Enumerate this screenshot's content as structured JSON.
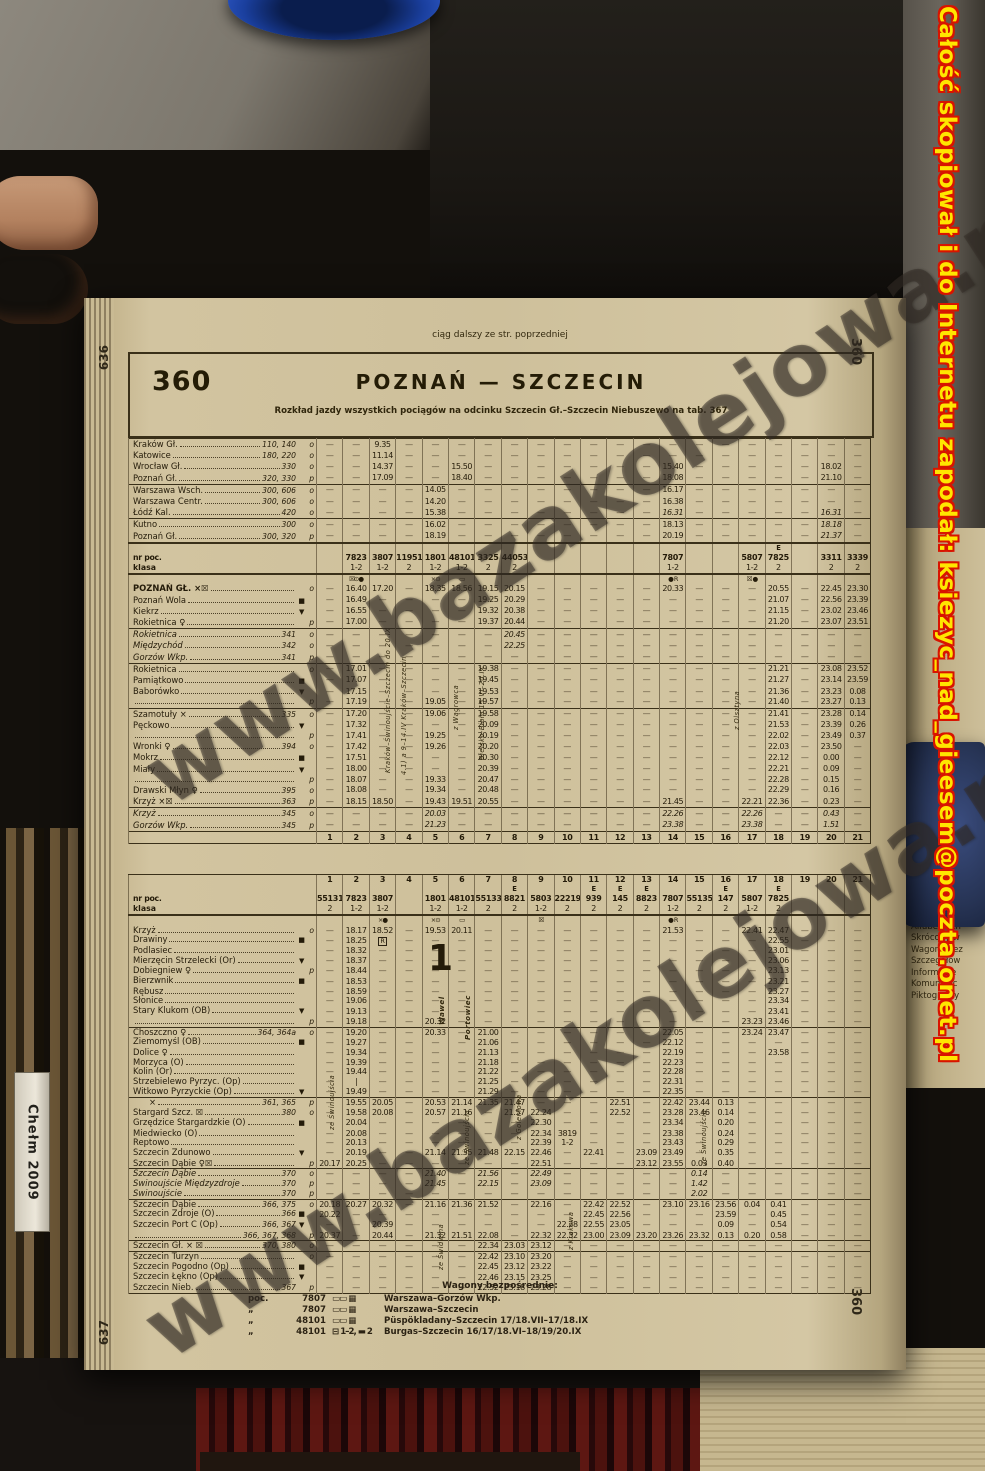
{
  "photo": {
    "red_overlay_text": "Całość skopiował i do Internetu zapodał: ksiezyc_nad_gieesem@poczta.onet.pl",
    "watermark": "www.bazakolejowa.pl",
    "left_spine_text": "Chełm 2009",
    "neighbor_page_lines": [
      "Infor. koleje",
      "Alfabetyczn",
      "Skrócony w",
      "Wagony bez",
      "Szczegółow",
      "Informacje",
      "Komunikac",
      "Piktogramy"
    ]
  },
  "upper_page": {
    "continuation_note": "ciąg dalszy ze str. poprzedniej",
    "page_edge_number": "636",
    "margin_number": "360",
    "table_number": "360",
    "title": "POZNAŃ — SZCZECIN",
    "subtitle": "Rozkład jazdy wszystkich pociągów na odcinku Szczecin Gł.–Szczecin Niebuszewo na tab. 367",
    "header": {
      "nr_label": "nr poc.",
      "klasa_label": "klasa",
      "nr": {
        "2": "7823",
        "3": "3807",
        "4": "11951",
        "5": "1801",
        "6": "48101",
        "7": "3325",
        "8": "44053",
        "14": "7807",
        "17": "5807",
        "18": "7825",
        "20": "3311",
        "21": "3339"
      },
      "klasa": {
        "2": "1-2",
        "3": "1-2",
        "4": "2",
        "5": "1-2",
        "6": "1-2",
        "7": "2",
        "8": "2",
        "14": "1-2",
        "17": "1-2",
        "18": "2",
        "20": "2",
        "21": "2"
      },
      "e_cols": {
        "18": "E"
      },
      "syms": {
        "2": "☒⊙●",
        "5": "×⊙",
        "6": "▭",
        "14": "● R",
        "17": "☒ ●"
      }
    },
    "origin_rows": [
      {
        "n": "Kraków Gł.",
        "r": "110, 140",
        "a": "o",
        "c": {
          "3": "9.35"
        }
      },
      {
        "n": "Katowice",
        "r": "180, 220",
        "a": "o",
        "c": {
          "3": "11.14"
        }
      },
      {
        "n": "Wrocław Gł.",
        "r": "330",
        "a": "o",
        "c": {
          "3": "14.37",
          "6": "15.50",
          "14": "15.40",
          "20": "18.02"
        }
      },
      {
        "n": "Poznań Gł.",
        "r": "320, 330",
        "a": "p",
        "c": {
          "3": "17.09",
          "6": "18.40",
          "14": "18.08",
          "20": "21.10"
        }
      },
      {
        "n": "Warszawa Wsch.",
        "r": "300, 606",
        "a": "o",
        "sep": 1,
        "c": {
          "5": "14.05",
          "14": "16.17"
        }
      },
      {
        "n": "Warszawa Centr.",
        "r": "300, 606",
        "a": "o",
        "c": {
          "5": "14.20",
          "14": "16.38"
        }
      },
      {
        "n": "Łódź Kal.",
        "r": "420",
        "a": "o",
        "c": {
          "5": "15.38",
          "14": "*16.31",
          "20": "*16.31"
        }
      },
      {
        "n": "Kutno",
        "r": "300",
        "a": "o",
        "sep": 1,
        "c": {
          "5": "16.02",
          "14": "18.13",
          "20": "*18.18"
        }
      },
      {
        "n": "Poznań Gł.",
        "r": "300, 320",
        "a": "p",
        "c": {
          "5": "18.19",
          "14": "20.19",
          "20": "*21.37"
        }
      }
    ],
    "rows": [
      {
        "n": "POZNAŃ GŁ. ×☒",
        "a": "o",
        "cap": 1,
        "c": {
          "2": "16.40",
          "3": "17.20",
          "5": "18.35",
          "6": "18.56",
          "7": "19.15",
          "8": "20.15",
          "14": "20.33",
          "18": "20.55",
          "20": "22.45",
          "21": "23.30"
        }
      },
      {
        "n": "Poznań Wola",
        "s": "■",
        "c": {
          "2": "16.49",
          "7": "19.25",
          "8": "20.29",
          "18": "21.07",
          "20": "22.56",
          "21": "23.39"
        }
      },
      {
        "n": "Kiekrz",
        "s": "▼",
        "c": {
          "2": "16.55",
          "7": "19.32",
          "8": "20.38",
          "18": "21.15",
          "20": "23.02",
          "21": "23.46"
        }
      },
      {
        "n": "Rokietnica ♀",
        "a": "p",
        "c": {
          "2": "17.00",
          "7": "19.37",
          "8": "20.44",
          "18": "21.20",
          "20": "23.07",
          "21": "23.51"
        }
      },
      {
        "n": "Rokietnica",
        "r": "341",
        "a": "o",
        "it": 1,
        "sep": 1,
        "c": {
          "8": "20.45"
        }
      },
      {
        "n": "Międzychód",
        "r": "342",
        "a": "o",
        "it": 1,
        "c": {
          "8": "22.25"
        }
      },
      {
        "n": "Gorzów Wkp.",
        "r": "341",
        "a": "p",
        "it": 1,
        "c": {}
      },
      {
        "n": "Rokietnica",
        "a": "o",
        "sep": 1,
        "c": {
          "2": "17.01",
          "7": "19.38",
          "18": "21.21",
          "20": "23.08",
          "21": "23.52"
        }
      },
      {
        "n": "Pamiątkowo",
        "s": "■",
        "c": {
          "2": "17.07",
          "7": "19.45",
          "18": "21.27",
          "20": "23.14",
          "21": "23.59"
        }
      },
      {
        "n": "Baborówko",
        "s": "▼",
        "c": {
          "2": "17.15",
          "7": "19.53",
          "18": "21.36",
          "20": "23.23",
          "21": "0.08"
        }
      },
      {
        "n": "",
        "a": "p",
        "c": {
          "2": "17.19",
          "5": "19.05",
          "7": "19.57",
          "18": "21.40",
          "20": "23.27",
          "21": "0.13"
        }
      },
      {
        "n": "Szamotuły ×",
        "r": "335",
        "a": "o",
        "sep": 1,
        "c": {
          "2": "17.20",
          "5": "19.06",
          "7": "19.58",
          "18": "21.41",
          "20": "23.28",
          "21": "0.14"
        }
      },
      {
        "n": "Pęckowo",
        "s": "▼",
        "c": {
          "2": "17.32",
          "7": "20.09",
          "18": "21.53",
          "20": "23.39",
          "21": "0.26"
        }
      },
      {
        "n": "",
        "a": "p",
        "c": {
          "2": "17.41",
          "5": "19.25",
          "7": "20.19",
          "18": "22.02",
          "20": "23.49",
          "21": "0.37"
        }
      },
      {
        "n": "Wronki ♀",
        "r": "394",
        "a": "o",
        "c": {
          "2": "17.42",
          "5": "19.26",
          "7": "20.20",
          "18": "22.03",
          "20": "23.50"
        }
      },
      {
        "n": "Mokrz",
        "s": "■",
        "c": {
          "2": "17.51",
          "7": "20.30",
          "18": "22.12",
          "20": "0.00"
        }
      },
      {
        "n": "Miały",
        "s": "▼",
        "c": {
          "2": "18.00",
          "7": "20.39",
          "18": "22.21",
          "20": "0.09"
        }
      },
      {
        "n": "",
        "a": "p",
        "c": {
          "2": "18.07",
          "5": "19.33",
          "7": "20.47",
          "18": "22.28",
          "20": "0.15"
        }
      },
      {
        "n": "Drawski Młyn ♀",
        "r": "395",
        "a": "o",
        "c": {
          "2": "18.08",
          "5": "19.34",
          "7": "20.48",
          "18": "22.29",
          "20": "0.16"
        }
      },
      {
        "n": "Krzyż ×☒",
        "r": "363",
        "a": "p",
        "c": {
          "2": "18.15",
          "3": "18.50",
          "5": "19.43",
          "6": "19.51",
          "7": "20.55",
          "14": "21.45",
          "17": "22.21",
          "18": "22.36",
          "20": "0.23"
        }
      },
      {
        "n": "Krzyż",
        "r": "345",
        "a": "o",
        "it": 1,
        "sep": 1,
        "c": {
          "5": "20.03",
          "14": "22.26",
          "17": "22.26",
          "20": "0.43"
        }
      },
      {
        "n": "Gorzów Wkp.",
        "r": "345",
        "a": "p",
        "it": 1,
        "c": {
          "5": "21.23",
          "14": "23.38",
          "17": "23.38",
          "20": "1.51"
        }
      }
    ],
    "col_numbers": [
      "1",
      "2",
      "3",
      "4",
      "5",
      "6",
      "7",
      "8",
      "9",
      "10",
      "11",
      "12",
      "13",
      "14",
      "15",
      "16",
      "17",
      "18",
      "19",
      "20",
      "21"
    ],
    "annotations": [
      {
        "text": "Kraków–Świnoujście–Szczecin do 20.IX"
      },
      {
        "text": "4.1) a 9–14.IV Kraków–Szczecin"
      },
      {
        "text": "z Wągrowca"
      },
      {
        "text": "Bielsko-Biała 15.VI–20.IX"
      },
      {
        "text": "z Olsztyna"
      }
    ]
  },
  "lower_page": {
    "page_edge_number": "637",
    "margin_number": "360",
    "header": {
      "nr_label": "nr poc.",
      "klasa_label": "klasa",
      "nr": {
        "1": "55131",
        "2": "7823",
        "3": "3807",
        "5": "1801",
        "6": "48101",
        "7": "55133",
        "8": "8821",
        "9": "5803",
        "10": "22219",
        "11": "939",
        "12": "145",
        "13": "8823",
        "14": "7807",
        "15": "55135",
        "16": "147",
        "17": "5807",
        "18": "7825"
      },
      "klasa": {
        "1": "2",
        "2": "1-2",
        "3": "1-2",
        "5": "1-2",
        "6": "1-2",
        "7": "2",
        "8": "2",
        "9": "1-2",
        "10": "2",
        "11": "2",
        "12": "2",
        "13": "2",
        "14": "1-2",
        "15": "2",
        "16": "2",
        "17": "1-2",
        "18": "2"
      },
      "e_cols": {
        "8": "E",
        "11": "E",
        "12": "E",
        "13": "E",
        "16": "E",
        "18": "E"
      },
      "syms": {
        "3": "×●",
        "5": "×⊙",
        "6": "▭",
        "9": "☒",
        "14": "● R"
      }
    },
    "col_numbers": [
      "1",
      "2",
      "3",
      "4",
      "5",
      "6",
      "7",
      "8",
      "9",
      "10",
      "11",
      "12",
      "13",
      "14",
      "15",
      "16",
      "17",
      "18",
      "19",
      "20",
      "21"
    ],
    "rows": [
      {
        "n": "Krzyż",
        "a": "o",
        "c": {
          "2": "18.17",
          "3": "18.52",
          "5": "19.53",
          "6": "20.11",
          "14": "21.53",
          "17": "22.41",
          "18": "22.47"
        }
      },
      {
        "n": "Drawiny",
        "s": "■",
        "c": {
          "2": "18.25",
          "3": "#R",
          "18": "22.55"
        }
      },
      {
        "n": "Podlasiec",
        "c": {
          "2": "18.32",
          "18": "23.01"
        }
      },
      {
        "n": "Mierzęcin Strzelecki (Or)",
        "s": "▼",
        "c": {
          "2": "18.37",
          "18": "23.06"
        }
      },
      {
        "n": "Dobiegniew ♀",
        "a": "p",
        "c": {
          "2": "18.44",
          "18": "23.13"
        }
      },
      {
        "n": "Bierzwnik",
        "s": "■",
        "c": {
          "2": "18.53",
          "18": "23.21"
        }
      },
      {
        "n": "Rębusz",
        "c": {
          "2": "18.59",
          "18": "23.27"
        }
      },
      {
        "n": "Słonice",
        "c": {
          "2": "19.06",
          "18": "23.34"
        }
      },
      {
        "n": "Stary Klukom (OB)",
        "s": "▼",
        "c": {
          "2": "19.13",
          "18": "23.41"
        }
      },
      {
        "n": "",
        "a": "p",
        "c": {
          "2": "19.18",
          "5": "20.32",
          "17": "23.23",
          "18": "23.46"
        }
      },
      {
        "n": "Choszczno ♀",
        "r": "364, 364a",
        "a": "o",
        "sep": 1,
        "c": {
          "2": "19.20",
          "5": "20.33",
          "7": "21.00",
          "14": "22.05",
          "17": "23.24",
          "18": "23.47"
        }
      },
      {
        "n": "Ziemomyśl (OB)",
        "s": "■",
        "c": {
          "2": "19.27",
          "7": "21.06",
          "14": "22.12"
        }
      },
      {
        "n": "Dolice ♀",
        "c": {
          "2": "19.34",
          "7": "21.13",
          "14": "22.19",
          "18": "23.58"
        }
      },
      {
        "n": "Morzyca (O)",
        "c": {
          "2": "19.39",
          "7": "21.18",
          "14": "22.23"
        }
      },
      {
        "n": "Kolin (Or)",
        "c": {
          "2": "19.44",
          "7": "21.22",
          "14": "22.28"
        }
      },
      {
        "n": "Strzebielewo Pyrzyc. (Op)",
        "c": {
          "2": "|",
          "7": "21.25",
          "14": "22.31"
        }
      },
      {
        "n": "Witkowo Pyrzyckie (Op)",
        "s": "▼",
        "c": {
          "2": "19.49",
          "7": "21.29",
          "14": "22.35"
        }
      },
      {
        "n": "×",
        "r": "361, 365",
        "a": "p",
        "sep": 1,
        "ind": 1,
        "c": {
          "2": "19.55",
          "3": "20.05",
          "5": "20.53",
          "6": "21.14",
          "7": "21.35",
          "8": "21.47",
          "12": "22.51",
          "14": "22.42",
          "15": "23.44",
          "16": "0.13"
        }
      },
      {
        "n": "Stargard Szcz. ☒",
        "r": "380",
        "a": "o",
        "c": {
          "2": "19.58",
          "3": "20.08",
          "5": "20.57",
          "6": "21.16",
          "8": "21.57",
          "9": "22.24",
          "12": "22.52",
          "14": "23.28",
          "15": "23.46",
          "16": "0.14"
        }
      },
      {
        "n": "Grzędzice Stargardzkie (O)",
        "s": "■",
        "c": {
          "2": "20.04",
          "9": "22.30",
          "14": "23.34",
          "16": "0.20"
        }
      },
      {
        "n": "Miedwiecko (O)",
        "c": {
          "2": "20.08",
          "9": "22.34",
          "10": "3819",
          "14": "23.38",
          "16": "0.24"
        }
      },
      {
        "n": "Reptowo",
        "c": {
          "2": "20.13",
          "9": "22.39",
          "10": "1-2",
          "14": "23.43",
          "16": "0.29"
        }
      },
      {
        "n": "Szczecin Zdunowo",
        "s": "▼",
        "c": {
          "2": "20.19",
          "5": "21.14",
          "6": "21.35",
          "7": "21.48",
          "8": "22.15",
          "9": "22.46",
          "11": "22.41",
          "13": "23.09",
          "14": "23.49",
          "16": "0.35"
        }
      },
      {
        "n": "Szczecin Dąbie ♀☒",
        "a": "p",
        "c": {
          "1": "20.17",
          "2": "20.25",
          "9": "22.51",
          "13": "23.12",
          "14": "23.55",
          "15": "0.03",
          "16": "0.40"
        }
      },
      {
        "n": "Szczecin Dąbie",
        "r": "370",
        "a": "o",
        "it": 1,
        "sep": 1,
        "c": {
          "5": "21.40",
          "7": "21.56",
          "9": "22.49",
          "15": "0.14"
        }
      },
      {
        "n": "Świnoujście Międzyzdroje",
        "r": "370",
        "a": "p",
        "it": 1,
        "c": {
          "5": "21.45",
          "7": "22.15",
          "9": "23.09",
          "15": "1.42"
        }
      },
      {
        "n": "Świnoujście",
        "r": "370",
        "a": "p",
        "it": 1,
        "c": {
          "15": "2.02"
        }
      },
      {
        "n": "Szczecin Dąbie",
        "r": "366, 375",
        "a": "o",
        "sep": 1,
        "c": {
          "1": "20.18",
          "2": "20.27",
          "3": "20.32",
          "5": "21.16",
          "6": "21.36",
          "7": "21.52",
          "9": "22.16",
          "11": "22.42",
          "12": "22.52",
          "14": "23.10",
          "15": "23.16",
          "16": "23.56",
          "17": "0.04",
          "18": "0.41"
        }
      },
      {
        "n": "Szczecin Zdroje (O)",
        "r": "366",
        "s": "■",
        "c": {
          "1": "20.22",
          "11": "22.45",
          "12": "22.56",
          "16": "23.59",
          "18": "0.45"
        }
      },
      {
        "n": "Szczecin Port C (Op)",
        "r": "366, 367",
        "s": "▼",
        "c": {
          "3": "20.39",
          "10": "22.28",
          "11": "22.55",
          "12": "23.05",
          "16": "0.09",
          "18": "0.54"
        }
      },
      {
        "n": "",
        "r": "366, 367, 368",
        "a": "p",
        "c": {
          "1": "20.37",
          "3": "20.44",
          "5": "21.32",
          "6": "21.51",
          "7": "22.08",
          "9": "22.32",
          "10": "22.32",
          "11": "23.00",
          "12": "23.09",
          "13": "23.20",
          "14": "23.26",
          "15": "23.32",
          "16": "0.13",
          "17": "0.20",
          "18": "0.58"
        }
      },
      {
        "n": "Szczecin Gł. × ☒",
        "r": "370, 380",
        "a": "o",
        "sep": 1,
        "c": {
          "7": "22.34",
          "8": "23.03",
          "9": "23.12"
        }
      },
      {
        "n": "Szczecin Turzyn",
        "a": "o",
        "sep": 1,
        "c": {
          "7": "22.42",
          "8": "23.10",
          "9": "23.20"
        }
      },
      {
        "n": "Szczecin Pogodno (Op)",
        "s": "■",
        "c": {
          "7": "22.45",
          "8": "23.12",
          "9": "23.22"
        }
      },
      {
        "n": "Szczecin Łękno (Op)",
        "s": "▼",
        "c": {
          "7": "22.46",
          "8": "23.15",
          "9": "23.25"
        }
      },
      {
        "n": "Szczecin Nieb.",
        "r": "367",
        "a": "p",
        "c": {
          "7": "22.52",
          "8": "23.18",
          "9": "23.28"
        }
      }
    ],
    "annotations": [
      {
        "text": "ze Świnoujścia"
      },
      {
        "text": "Wawel"
      },
      {
        "text": "Portowiec"
      },
      {
        "text": "1"
      },
      {
        "text": "ze Świnoujścia"
      },
      {
        "text": "z Goleniowa"
      },
      {
        "text": "z Krakowa"
      },
      {
        "text": "ze Świdwina"
      },
      {
        "text": "ze Świnoujścia"
      }
    ],
    "notes": {
      "title": "Wagony bezpośrednie:",
      "rows": [
        {
          "p": "poc.",
          "nr": "7807",
          "ic": "▭▭ ▦",
          "rel": "Warszawa–Gorzów Wkp."
        },
        {
          "p": "„",
          "nr": "7807",
          "ic": "▭▭ ▦",
          "rel": "Warszawa–Szczecin"
        },
        {
          "p": "„",
          "nr": "48101",
          "ic": "▭▭ ▦",
          "rel": "Püspökladany–Szczecin 17/18.VII–17/18.IX"
        },
        {
          "p": "„",
          "nr": "48101",
          "ic": "⊟ 1–2, ▬ 2",
          "rel": "Burgas–Szczecin 16/17/18.VI–18/19/20.IX"
        }
      ]
    }
  }
}
